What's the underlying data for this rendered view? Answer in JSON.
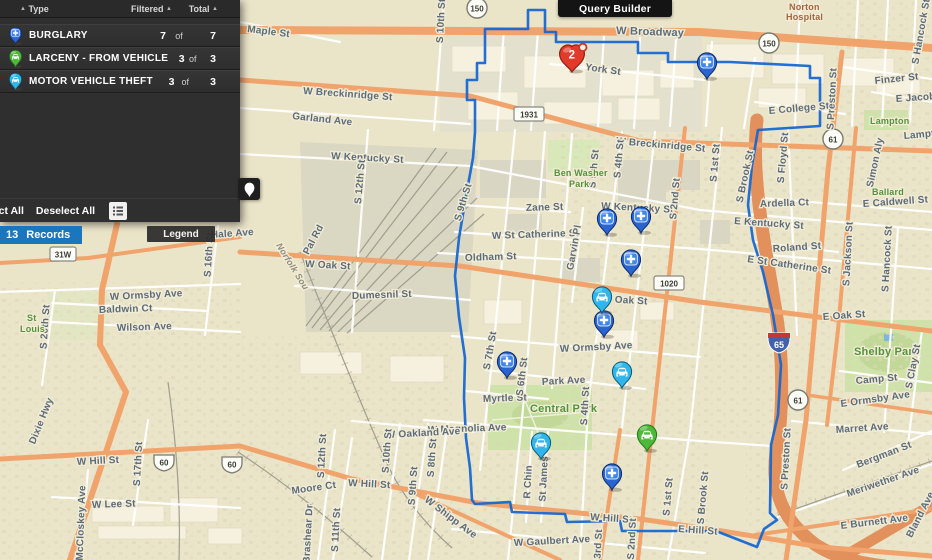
{
  "toolbar": {
    "query_builder_label": "Query Builder"
  },
  "panel": {
    "headers": {
      "type": "Type",
      "filtered": "Filtered",
      "total": "Total"
    },
    "rows": [
      {
        "type": "burglary",
        "label": "BURGLARY",
        "filtered": "7",
        "of": "of",
        "total": "7"
      },
      {
        "type": "larceny",
        "label": "LARCENY - FROM VEHICLE",
        "filtered": "3",
        "of": "of",
        "total": "3"
      },
      {
        "type": "mvt",
        "label": "MOTOR VEHICLE THEFT",
        "filtered": "3",
        "of": "of",
        "total": "3"
      }
    ],
    "select_all_label": "Select All",
    "deselect_all_label": "Deselect All"
  },
  "overlay": {
    "records_count": "13",
    "records_text": "Records",
    "legend_label": "Legend"
  },
  "colors": {
    "boundary": "#1767d2",
    "burglary": "#2a64d0",
    "burglary_inner": "#3f86ea",
    "mvt": "#30b6ea",
    "larceny": "#4eb939",
    "cluster": "#e23b2c",
    "records_badge": "#1c76bd",
    "road_orange": "#f1a36c",
    "panel_bg": "#2f2f2f"
  },
  "map": {
    "boundary_path": "M485 29 L528 29 L528 10 L545 10 L545 32 L556 32 L556 42 L638 42 L638 53 L668 53 L668 62 L730 62 L810 66 L810 78 L820 78 L820 126 L758 130 L752 165 L748 205 L753 240 L763 272 L773 315 L781 365 L778 415 L771 445 L770 513 L777 520 L764 529 L757 547 L716 531 L622 531 L620 521 L567 522 L565 514 L512 512 L510 502 L475 504 L472 500 L470 468 L466 438 L464 398 L465 358 L459 317 L455 276 L459 238 L466 196 L473 158 L475 132 L475 100 L467 100 L467 80 L477 80 L477 63 L485 63 Z",
    "cluster": {
      "count": "2",
      "x": 572,
      "y": 56
    },
    "markers": [
      {
        "type": "burglary",
        "x": 707,
        "y": 63
      },
      {
        "type": "burglary",
        "x": 607,
        "y": 219
      },
      {
        "type": "burglary",
        "x": 641,
        "y": 217
      },
      {
        "type": "burglary",
        "x": 631,
        "y": 260
      },
      {
        "type": "burglary",
        "x": 604,
        "y": 321
      },
      {
        "type": "burglary",
        "x": 507,
        "y": 362
      },
      {
        "type": "burglary",
        "x": 612,
        "y": 474
      },
      {
        "type": "mvt",
        "x": 602,
        "y": 297
      },
      {
        "type": "mvt",
        "x": 622,
        "y": 372
      },
      {
        "type": "mvt",
        "x": 541,
        "y": 443
      },
      {
        "type": "larceny",
        "x": 647,
        "y": 435
      }
    ],
    "shields": [
      {
        "t": "150",
        "s": "circle",
        "x": 477,
        "y": 8
      },
      {
        "t": "150",
        "s": "circle",
        "x": 769,
        "y": 43
      },
      {
        "t": "61",
        "s": "circle",
        "x": 833,
        "y": 139
      },
      {
        "t": "61",
        "s": "circle",
        "x": 798,
        "y": 400
      },
      {
        "t": "1931",
        "s": "rect",
        "x": 529,
        "y": 114
      },
      {
        "t": "1020",
        "s": "rect",
        "x": 669,
        "y": 283
      },
      {
        "t": "31W",
        "s": "rect",
        "x": 63,
        "y": 254
      },
      {
        "t": "60",
        "s": "us",
        "x": 164,
        "y": 462
      },
      {
        "t": "60",
        "s": "us",
        "x": 232,
        "y": 464
      },
      {
        "t": "65",
        "s": "i65",
        "x": 779,
        "y": 342
      }
    ],
    "street_labels": [
      {
        "t": "Maple St",
        "x": 247,
        "y": 32,
        "r": 7
      },
      {
        "t": "S 10th St",
        "x": 444,
        "y": 21,
        "r": -87
      },
      {
        "t": "W Broadway",
        "x": 616,
        "y": 34,
        "r": 2,
        "s": 11
      },
      {
        "t": "York St",
        "x": 585,
        "y": 70,
        "r": 8
      },
      {
        "t": "Norton",
        "x": 789,
        "y": 10,
        "c": "poi",
        "s": 9
      },
      {
        "t": "Hospital",
        "x": 786,
        "y": 20,
        "c": "poi",
        "s": 9
      },
      {
        "t": "W Breckinridge St",
        "x": 303,
        "y": 94,
        "r": 4
      },
      {
        "t": "W Breckinridge St",
        "x": 616,
        "y": 144,
        "r": 5
      },
      {
        "t": "Garland Ave",
        "x": 292,
        "y": 119,
        "r": 6
      },
      {
        "t": "Finzer St",
        "x": 875,
        "y": 84,
        "r": -6
      },
      {
        "t": "E Jacob St",
        "x": 896,
        "y": 102,
        "r": -4
      },
      {
        "t": "E College St",
        "x": 769,
        "y": 114,
        "r": -5
      },
      {
        "t": "Lampton",
        "x": 870,
        "y": 124,
        "c": "park",
        "s": 9
      },
      {
        "t": "Lampton St",
        "x": 904,
        "y": 139,
        "r": -5
      },
      {
        "t": "S Hancock St",
        "x": 924,
        "y": 32,
        "r": -80
      },
      {
        "t": "S Floyd St",
        "x": 786,
        "y": 158,
        "r": -85
      },
      {
        "t": "Simon Aly",
        "x": 878,
        "y": 163,
        "r": -78
      },
      {
        "t": "Ballard",
        "x": 872,
        "y": 195,
        "c": "park",
        "s": 9
      },
      {
        "t": "E Caldwell St",
        "x": 863,
        "y": 207,
        "r": -4
      },
      {
        "t": "Ardella Ct",
        "x": 760,
        "y": 207,
        "r": -2
      },
      {
        "t": "W Kentucky St",
        "x": 331,
        "y": 159,
        "r": 3
      },
      {
        "t": "W Kentucky St",
        "x": 601,
        "y": 209,
        "r": 3
      },
      {
        "t": "E Kentucky St",
        "x": 734,
        "y": 224,
        "r": 4
      },
      {
        "t": "Zane St",
        "x": 526,
        "y": 211,
        "r": -2
      },
      {
        "t": "W St Catherine St",
        "x": 492,
        "y": 239,
        "r": -2
      },
      {
        "t": "E St Catherine St",
        "x": 747,
        "y": 262,
        "r": 8
      },
      {
        "t": "Roland St",
        "x": 773,
        "y": 252,
        "r": -4
      },
      {
        "t": "Oldham St",
        "x": 465,
        "y": 261,
        "r": -2
      },
      {
        "t": "Garvin Pl",
        "x": 577,
        "y": 248,
        "r": -80
      },
      {
        "t": "S 12th St",
        "x": 363,
        "y": 182,
        "r": -85
      },
      {
        "t": "Pal Rd",
        "x": 316,
        "y": 241,
        "r": -62
      },
      {
        "t": "Norfolk Sou",
        "x": 290,
        "y": 268,
        "r": 58,
        "c": "rail",
        "s": 9
      },
      {
        "t": "W Oak St",
        "x": 305,
        "y": 267,
        "r": 3
      },
      {
        "t": "W Oak St",
        "x": 602,
        "y": 302,
        "r": 3
      },
      {
        "t": "E Oak St",
        "x": 823,
        "y": 320,
        "r": -4
      },
      {
        "t": "Dumesnil St",
        "x": 352,
        "y": 299,
        "r": -2
      },
      {
        "t": "S 9th St",
        "x": 466,
        "y": 203,
        "r": -73
      },
      {
        "t": "S Brook St",
        "x": 748,
        "y": 177,
        "r": -78
      },
      {
        "t": "S 1st St",
        "x": 718,
        "y": 163,
        "r": -85
      },
      {
        "t": "S 2nd St",
        "x": 678,
        "y": 199,
        "r": -85
      },
      {
        "t": "S 4th St",
        "x": 622,
        "y": 159,
        "r": -85
      },
      {
        "t": "S 5th St",
        "x": 597,
        "y": 169,
        "r": -85
      },
      {
        "t": "Ben Washer",
        "x": 554,
        "y": 176,
        "c": "park",
        "s": 9
      },
      {
        "t": "Park",
        "x": 569,
        "y": 187,
        "c": "park",
        "s": 9
      },
      {
        "t": "S Preston St",
        "x": 835,
        "y": 99,
        "r": -87
      },
      {
        "t": "S Jackson St",
        "x": 851,
        "y": 254,
        "r": -87
      },
      {
        "t": "S Hancock St",
        "x": 890,
        "y": 259,
        "r": -87
      },
      {
        "t": "W Ormsby Ave",
        "x": 110,
        "y": 300,
        "r": -3
      },
      {
        "t": "Baldwin Ct",
        "x": 99,
        "y": 313,
        "r": -2
      },
      {
        "t": "Wilson Ave",
        "x": 117,
        "y": 331,
        "r": -2
      },
      {
        "t": "S 20th St",
        "x": 48,
        "y": 327,
        "r": -86
      },
      {
        "t": "S 16th St",
        "x": 212,
        "y": 255,
        "r": -86
      },
      {
        "t": "St",
        "x": 27,
        "y": 321,
        "c": "park",
        "s": 9
      },
      {
        "t": "Louis",
        "x": 20,
        "y": 332,
        "c": "park",
        "s": 9
      },
      {
        "t": "Hale Ave",
        "x": 211,
        "y": 238,
        "r": -4
      },
      {
        "t": "W Ormsby Ave",
        "x": 560,
        "y": 352,
        "r": -3
      },
      {
        "t": "Park Ave",
        "x": 542,
        "y": 385,
        "r": -3
      },
      {
        "t": "Myrtle St",
        "x": 483,
        "y": 402,
        "r": -2
      },
      {
        "t": "Central Park",
        "x": 530,
        "y": 412,
        "c": "park",
        "s": 11
      },
      {
        "t": "S 7th St",
        "x": 493,
        "y": 351,
        "r": -80
      },
      {
        "t": "S 6th St",
        "x": 525,
        "y": 377,
        "r": -83
      },
      {
        "t": "S 4th St",
        "x": 588,
        "y": 406,
        "r": -87
      },
      {
        "t": "W Magnolia Ave",
        "x": 428,
        "y": 433,
        "r": -2
      },
      {
        "t": "W Oakland Ave",
        "x": 386,
        "y": 438,
        "r": -3
      },
      {
        "t": "S 12th St",
        "x": 325,
        "y": 456,
        "r": -87
      },
      {
        "t": "S 10th St",
        "x": 390,
        "y": 451,
        "r": -86
      },
      {
        "t": "S 9th St",
        "x": 416,
        "y": 486,
        "r": -86
      },
      {
        "t": "S 8th St",
        "x": 435,
        "y": 458,
        "r": -86
      },
      {
        "t": "W Hill St",
        "x": 77,
        "y": 465,
        "r": -3
      },
      {
        "t": "W Hill St",
        "x": 348,
        "y": 486,
        "r": 3
      },
      {
        "t": "W Hill St",
        "x": 590,
        "y": 520,
        "r": 4
      },
      {
        "t": "E Hill St",
        "x": 678,
        "y": 532,
        "r": 4
      },
      {
        "t": "Moore Ct",
        "x": 292,
        "y": 494,
        "r": -8
      },
      {
        "t": "S 11th St",
        "x": 339,
        "y": 530,
        "r": -87
      },
      {
        "t": "Brashear Dr",
        "x": 311,
        "y": 534,
        "r": -87
      },
      {
        "t": "W Shipp Ave",
        "x": 424,
        "y": 501,
        "r": 37
      },
      {
        "t": "Dixie Hwy",
        "x": 44,
        "y": 422,
        "r": -68
      },
      {
        "t": "S 17th St",
        "x": 141,
        "y": 464,
        "r": -87
      },
      {
        "t": "W Lee St",
        "x": 92,
        "y": 508,
        "r": -2
      },
      {
        "t": "McCloskey Ave",
        "x": 84,
        "y": 523,
        "r": -88
      },
      {
        "t": "W Gaulbert Ave",
        "x": 514,
        "y": 546,
        "r": -3
      },
      {
        "t": "R Chin",
        "x": 531,
        "y": 482,
        "r": -87
      },
      {
        "t": "St James Ct",
        "x": 547,
        "y": 472,
        "r": -87
      },
      {
        "t": "S 3rd St",
        "x": 601,
        "y": 549,
        "r": -87
      },
      {
        "t": "S 2nd St",
        "x": 635,
        "y": 539,
        "r": -87
      },
      {
        "t": "S 1st St",
        "x": 671,
        "y": 497,
        "r": -85
      },
      {
        "t": "S Brook St",
        "x": 706,
        "y": 498,
        "r": -85
      },
      {
        "t": "Camp St",
        "x": 856,
        "y": 384,
        "r": -5
      },
      {
        "t": "Shelby Park",
        "x": 854,
        "y": 355,
        "c": "park",
        "s": 11
      },
      {
        "t": "S Clay St",
        "x": 916,
        "y": 367,
        "r": -79
      },
      {
        "t": "E Ormsby Ave",
        "x": 841,
        "y": 407,
        "r": -8
      },
      {
        "t": "Marret Ave",
        "x": 836,
        "y": 433,
        "r": -4
      },
      {
        "t": "Bergman St",
        "x": 858,
        "y": 468,
        "r": -21
      },
      {
        "t": "Meriwether Ave",
        "x": 848,
        "y": 497,
        "r": -19
      },
      {
        "t": "E Burnett Ave",
        "x": 841,
        "y": 529,
        "r": -7
      },
      {
        "t": "Bland Ave",
        "x": 923,
        "y": 516,
        "r": -63
      },
      {
        "t": "S Preston St",
        "x": 789,
        "y": 459,
        "r": -87
      }
    ]
  }
}
